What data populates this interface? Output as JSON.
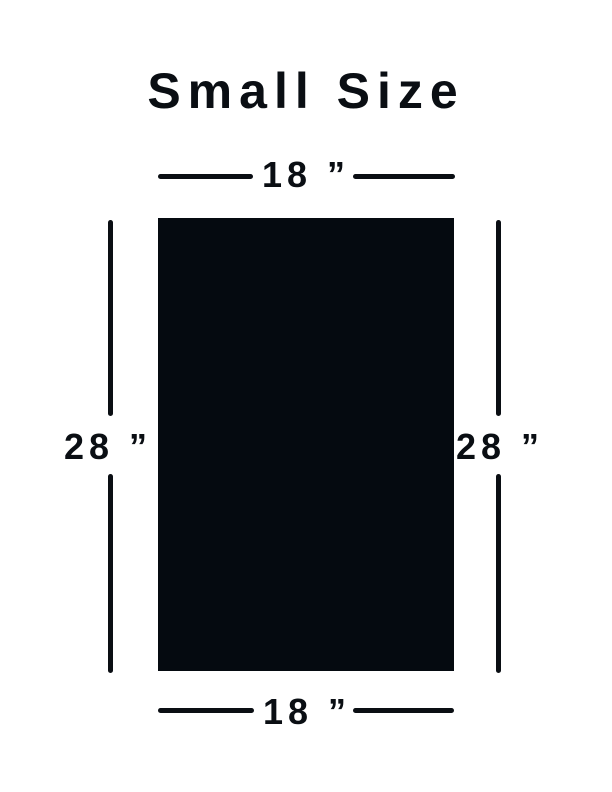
{
  "title": "Small Size",
  "diagram": {
    "top_dimension": {
      "label": "18 ”"
    },
    "bottom_dimension": {
      "label": "18 ”"
    },
    "left_dimension": {
      "label": "28 ”"
    },
    "right_dimension": {
      "label": "28 ”"
    },
    "rectangle": {
      "width_inches": 18,
      "height_inches": 28
    },
    "colors": {
      "ink": "#0a0e13",
      "rectangle_fill": "#050a10",
      "background": "#ffffff"
    }
  }
}
